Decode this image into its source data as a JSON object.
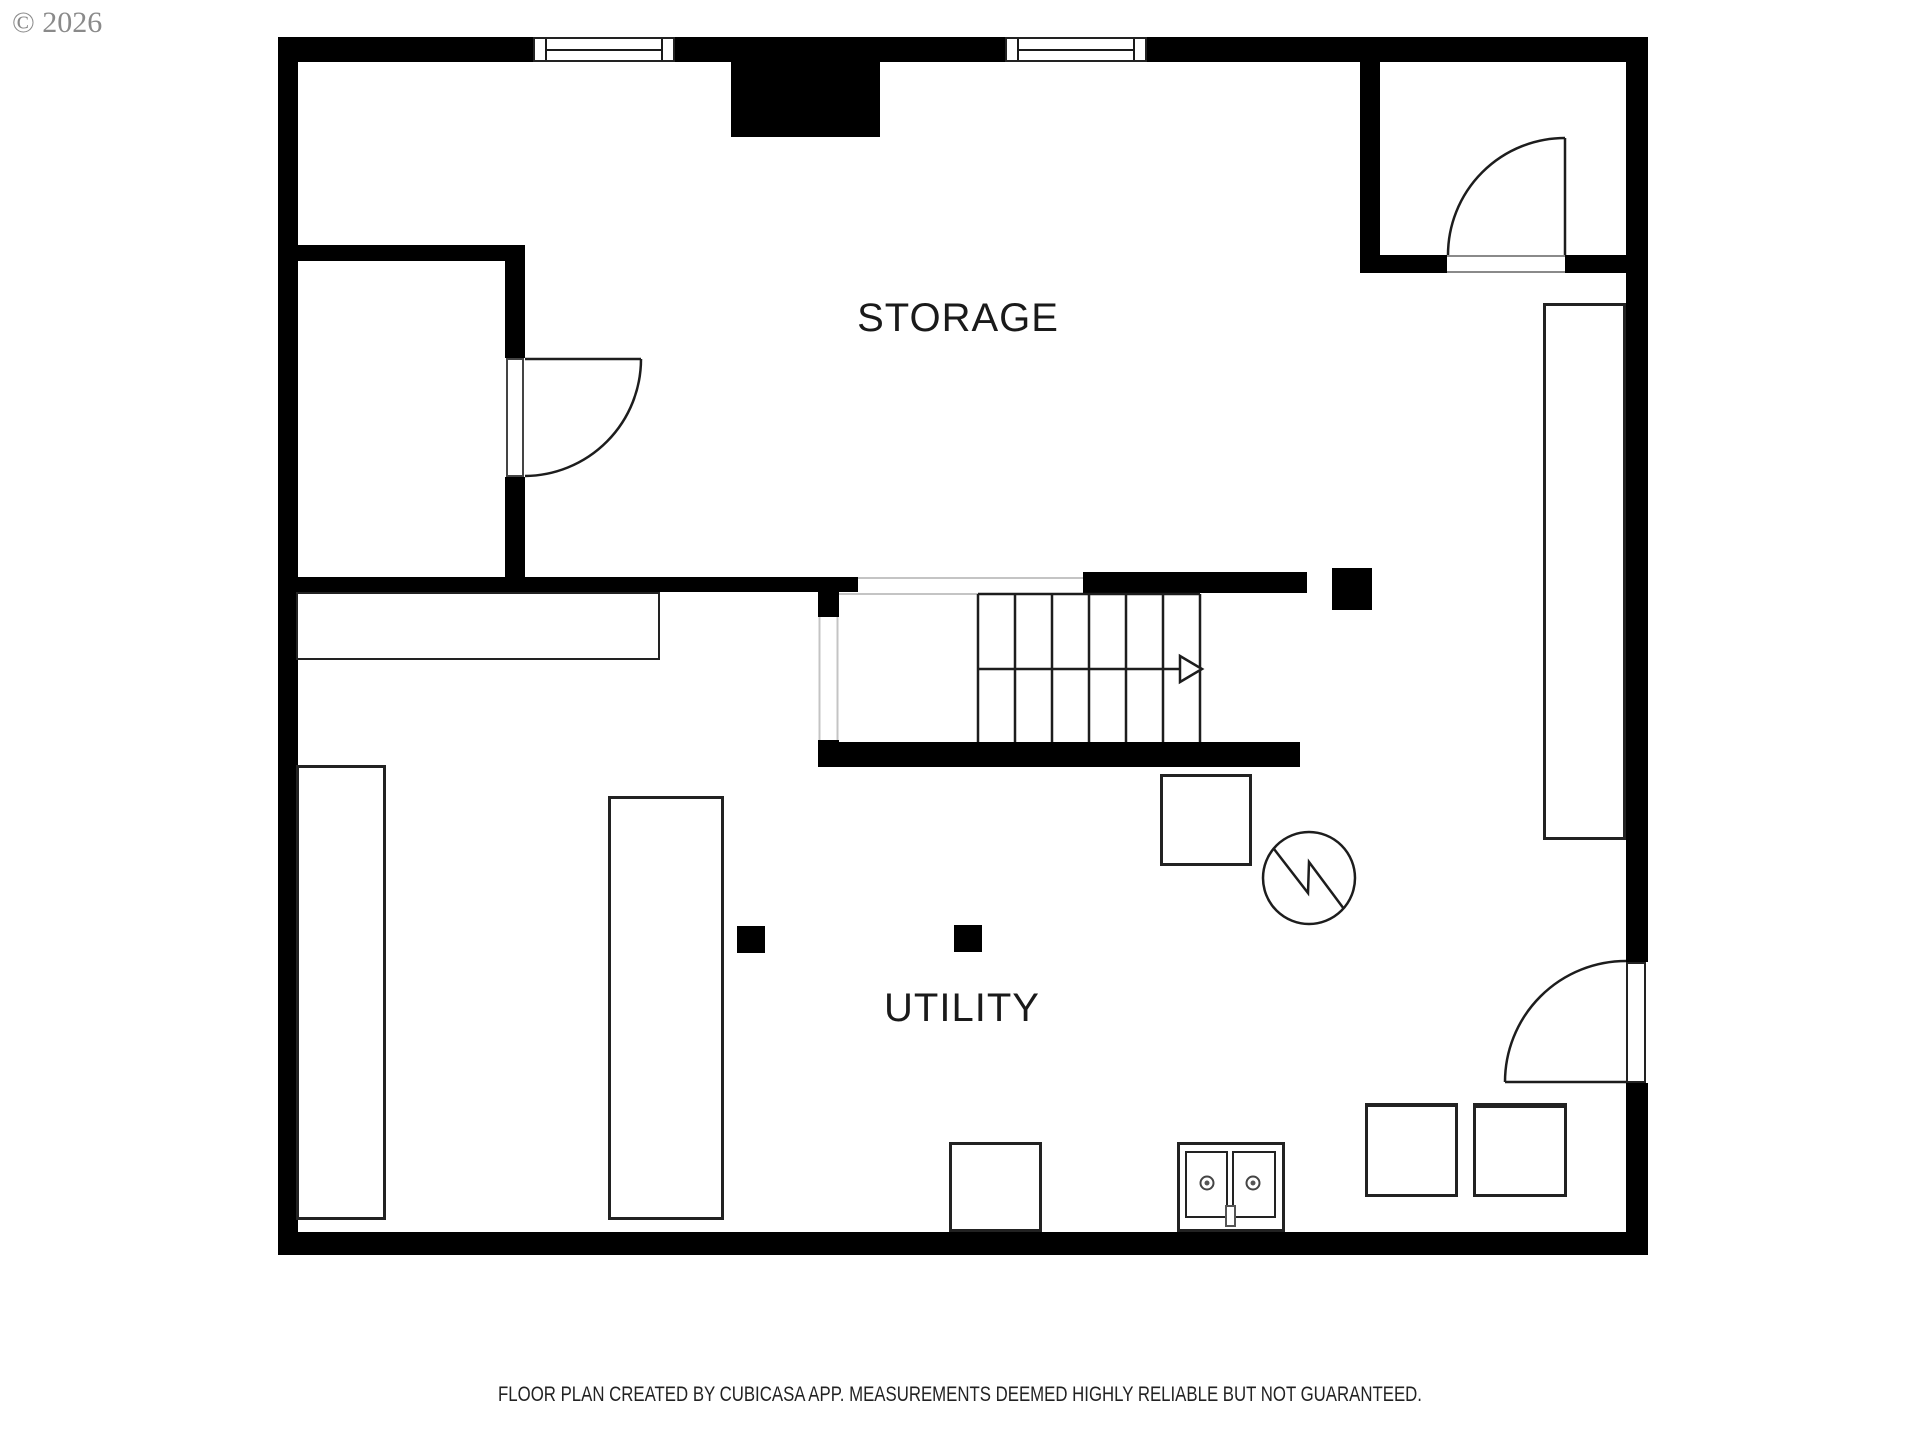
{
  "header": {
    "copyright": "© 2026"
  },
  "rooms": [
    {
      "label": "STORAGE"
    },
    {
      "label": "UTILITY"
    }
  ],
  "footer": {
    "disclaimer": "FLOOR PLAN CREATED BY CUBICASA APP. MEASUREMENTS DEEMED HIGHLY RELIABLE BUT NOT GUARANTEED."
  },
  "colors": {
    "wall": "#000000",
    "line": "#1d1d1d",
    "open_edge": "#c4c4c4",
    "text": "#1a1a1a",
    "muted_text": "#8a8a8a",
    "background": "#ffffff"
  },
  "stairs": {
    "tread_count": 6,
    "direction_arrow": "right"
  },
  "symbols": {
    "windows": 2,
    "doors": 3,
    "water_heater": "circle-with-zigzag",
    "furnace": "square",
    "sink": "double-basin-with-two-faucets-and-drain",
    "appliances": 3,
    "posts": 3,
    "shelves": 4,
    "chimney": "black-block"
  }
}
